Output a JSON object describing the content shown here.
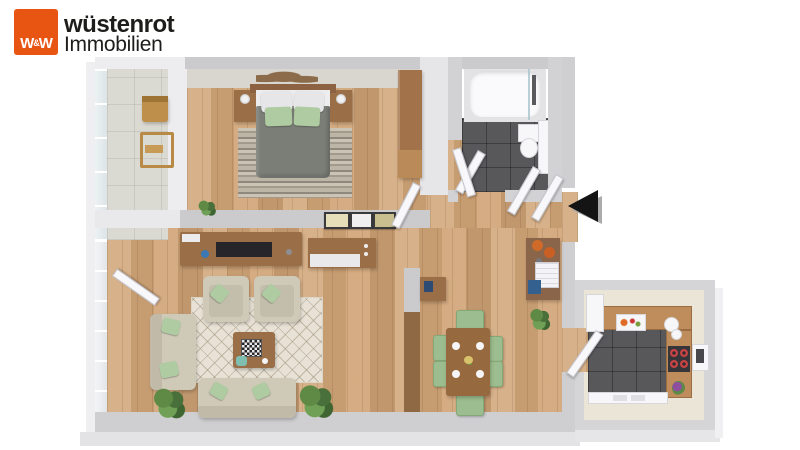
{
  "logo": {
    "monogram": {
      "w_left": "W",
      "ampersand": "&",
      "w_right": "W"
    },
    "brand": "wüstenrot",
    "subtitle": "Immobilien"
  },
  "floorplan": {
    "type": "3d-top-down-apartment-render",
    "rooms": [
      "balcony",
      "bedroom",
      "bathroom",
      "hallway",
      "living-room",
      "dining-area",
      "kitchen"
    ],
    "entrance_marker": "black-arrow-pointing-left-at-apartment-door",
    "colors": {
      "brand_orange": "#E85412",
      "wall": "#CBCBCE",
      "wall_light": "#EDEDEF",
      "wood": "#D3A87C",
      "tile_dark": "#58585B",
      "tile_light": "#DBDAD2",
      "kitchen_cream": "#EAE5D6",
      "counter_wood": "#BE8D5B",
      "sofa_beige": "#CFC9B8",
      "accent_green": "#AECBA1",
      "chair_green": "#9CBD8F",
      "furniture_brown": "#9A6E46",
      "rug": "#E8E2D6",
      "duvet_gray": "#7B7E77",
      "arrow_black": "#141414"
    }
  }
}
